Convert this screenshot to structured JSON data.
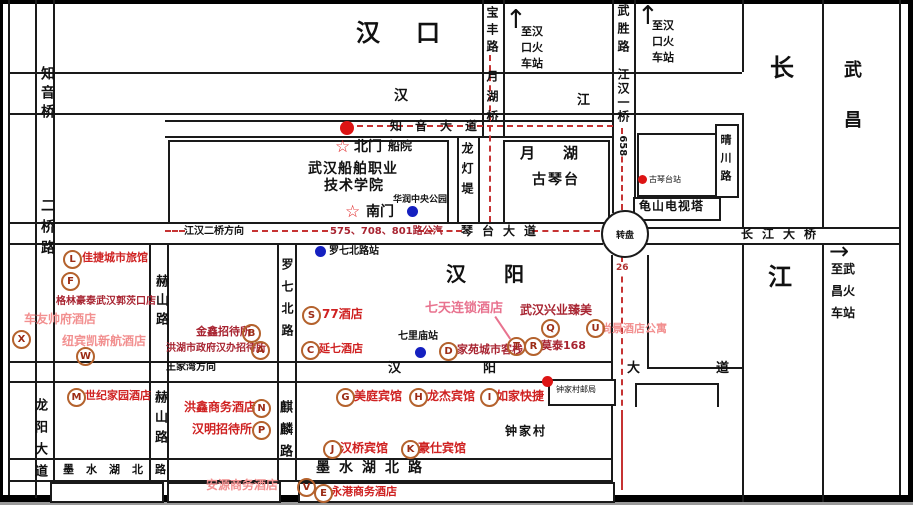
{
  "areas": {
    "hankou": "汉口",
    "hanyang": "汉阳",
    "wuchang": "武昌",
    "changjiang_top": "长",
    "changjiang_bottom": "江",
    "hanjiang_han": "汉",
    "hanjiang_jiang": "江"
  },
  "roads": {
    "zhiyin_bridge": "知音桥",
    "erqiao_road": "二桥路",
    "longyang_avenue": "龙阳大道",
    "heshan_road": "赫山路",
    "luoqibei_road": "罗七北路",
    "qilin_road": "麒麟路",
    "longdeng_di": "龙灯堤",
    "baofeng_road": "宝丰路",
    "yuehu_bridge": "月湖桥",
    "wusheng_road": "武胜路",
    "jianghan_1st_bridge": "江汉一桥",
    "qingchuan_road": "晴川路",
    "zhiyin_avenue": "知音大道",
    "qintai_avenue": "琴台大道",
    "changjiang_bridge": "长江大桥",
    "hanyang_avenue": [
      "汉",
      "阳",
      "大",
      "道"
    ],
    "moshuihu_north_road": "墨水湖北路"
  },
  "directions": {
    "to_hankou_rail_left": "至汉\n口火\n车站",
    "to_hankou_rail_right": "至汉\n口火\n车站",
    "to_wuchang_rail": "至武\n昌火\n车站",
    "jianghan_2nd_bridge_dir": "江汉二桥方向",
    "wangjiawan_dir": "王家湾方向",
    "up_arrow": "↑",
    "right_arrow": "→"
  },
  "transit": {
    "qintai_bus": "575、708、801路公汽",
    "bus_658": "658",
    "bus_26": "26",
    "roundabout": "转盘",
    "stops": {
      "luoqibei": "罗七北路站",
      "qilimiao": "七里庙站",
      "guqintai": "古琴台站"
    }
  },
  "landmarks": {
    "yuehu": "月湖",
    "guqintai": "古琴台",
    "huarun_park": "华润中央公园",
    "tv_tower": "龟山电视塔",
    "post_office": "钟家村邮局",
    "zhongjiacun": "钟家村"
  },
  "school": {
    "name_line1": "武汉船舶职业",
    "name_line2": "技术学院",
    "north_gate": "北门",
    "south_gate": "南门",
    "academy_short": "船院",
    "gate_star": "☆"
  },
  "hotels": [
    {
      "letter": "L",
      "name": "佳捷城市旅馆"
    },
    {
      "letter": "F",
      "name": "格林豪泰武汉郭茨口店"
    },
    {
      "letter": "X",
      "name": "车友帅府酒店"
    },
    {
      "letter": "W",
      "name": "纽宾凯新航酒店"
    },
    {
      "letter": "B",
      "name": "金鑫招待所"
    },
    {
      "letter": "A",
      "name": "洪湖市政府汉办招待所"
    },
    {
      "letter": "M",
      "name": "世纪家园酒店"
    },
    {
      "letter": "N",
      "name": "洪鑫商务酒店"
    },
    {
      "letter": "P",
      "name": "汉明招待所"
    },
    {
      "letter": "S",
      "name": "77酒店"
    },
    {
      "letter": "C",
      "name": "延七酒店"
    },
    {
      "letter": "D",
      "name": "家苑城市客栈"
    },
    {
      "letter": "T",
      "name": "七天连锁酒店"
    },
    {
      "letter": "R",
      "name": "莫泰168"
    },
    {
      "letter": "Q",
      "name": "武汉兴业臻美"
    },
    {
      "letter": "U",
      "name": "尚景酒店公寓"
    },
    {
      "letter": "G",
      "name": "美庭宾馆"
    },
    {
      "letter": "H",
      "name": "龙杰宾馆"
    },
    {
      "letter": "I",
      "name": "如家快捷"
    },
    {
      "letter": "J",
      "name": "汉桥宾馆"
    },
    {
      "letter": "K",
      "name": "豪仕宾馆"
    },
    {
      "letter": "V",
      "name": "安源商务酒店"
    },
    {
      "letter": "E",
      "name": "永港商务酒店"
    }
  ],
  "palette": {
    "hotel_red": "#cf2121",
    "hotel_pink": "#f29090",
    "hotel_dark_red": "#a82431",
    "hotel_rose": "#e8738f",
    "marker_brown": "#b4622d",
    "marker_letter": "#9c2c16",
    "route_red": "#c63333",
    "stop_blue": "#1520c0",
    "dot_red": "#dd1414",
    "line_black": "#1a1a1a"
  }
}
